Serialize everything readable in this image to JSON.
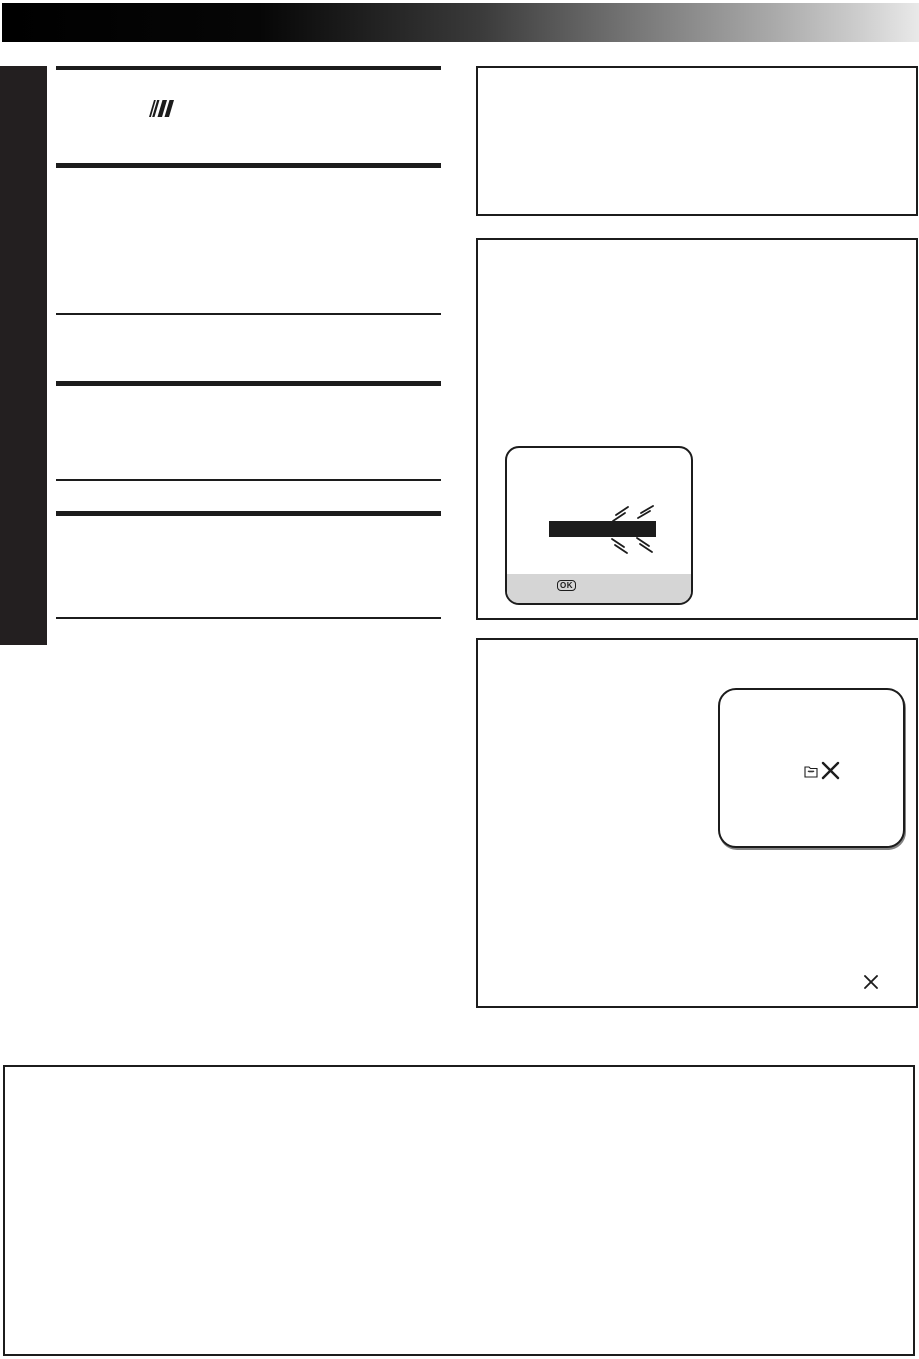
{
  "document": {
    "kind": "printed-manual-page",
    "background": "#ffffff"
  },
  "header_bar": {
    "gradient_left": "#000000",
    "gradient_right": "#e9e9e9"
  },
  "side_tab": {
    "color": "#231f20"
  },
  "left_column": {
    "rule_color": "#1c1c1c",
    "section_marker_icon": "italic-slashes-icon"
  },
  "frames": {
    "border_color": "#1c1c1c",
    "count": 4
  },
  "screen_mockup": {
    "border_color": "#1c1c1c",
    "blinking_bar_color": "#1c1c1c",
    "button_strip_color": "#d5d5d5",
    "ok_button_label": "OK",
    "flash_marks_icon": "blink-rays-icon"
  },
  "folder_screen": {
    "folder_icon": "open-folder-icon",
    "x_icon": "x-mark-icon"
  },
  "corner_x_icon": "x-mark-icon",
  "footnote_box": {}
}
